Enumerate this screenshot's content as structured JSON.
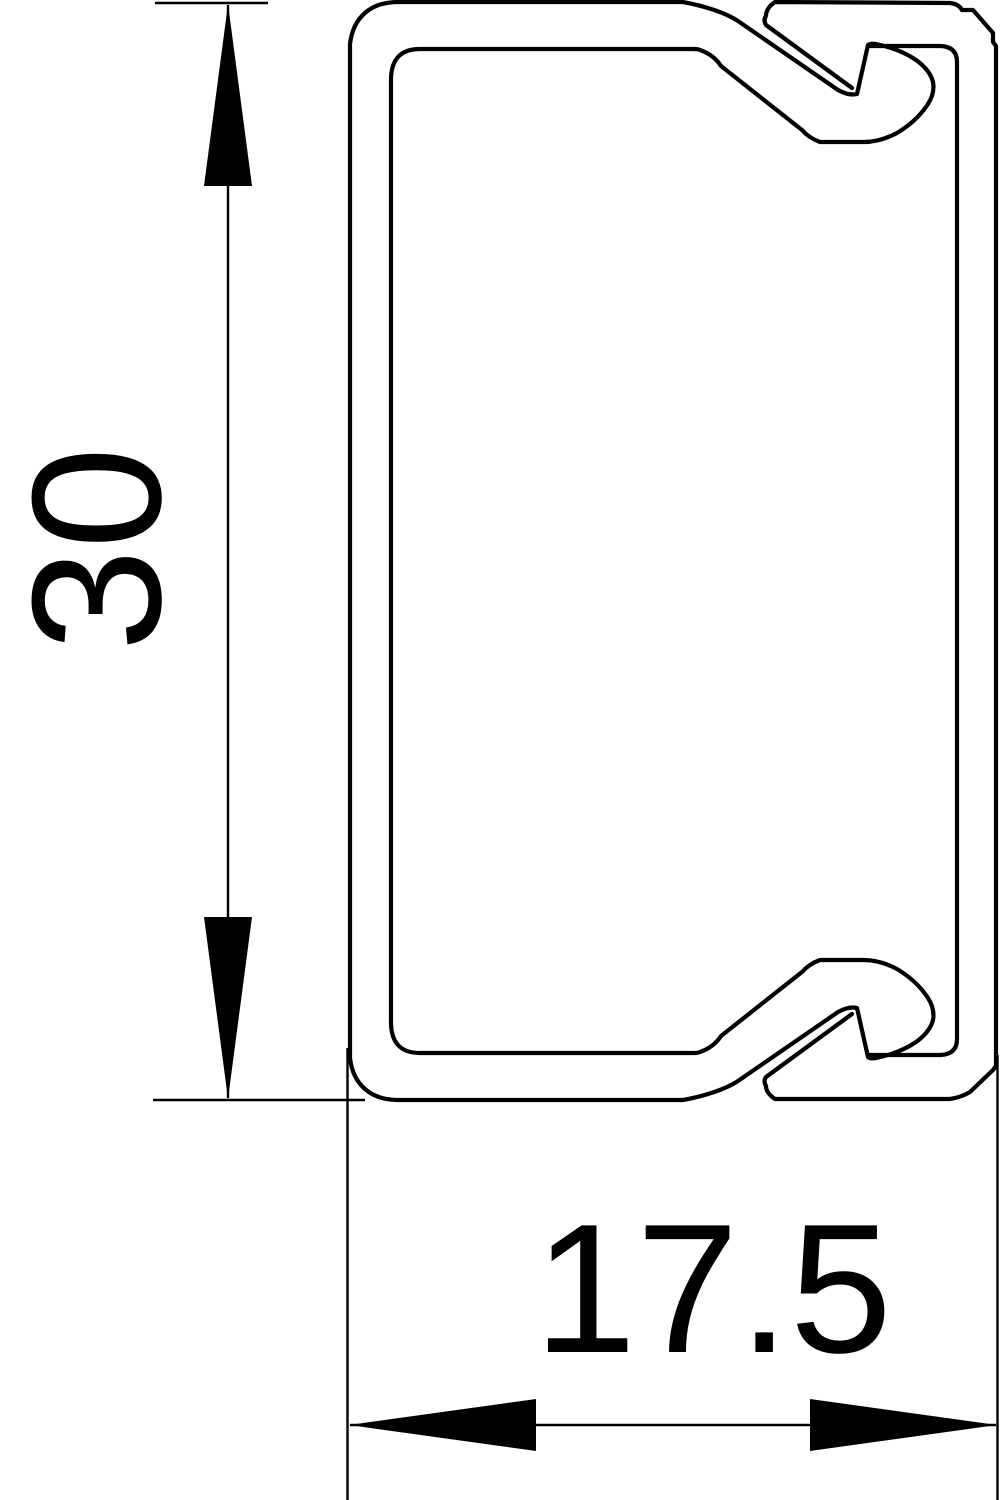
{
  "drawing": {
    "type": "technical-cross-section",
    "subject": "cable-trunking-profile-with-snap-on-cover",
    "background_color": "#ffffff",
    "line_color": "#000000",
    "dimensions": {
      "height": {
        "value": "30",
        "orientation": "vertical",
        "side": "left"
      },
      "width": {
        "value": "17.5",
        "orientation": "horizontal",
        "side": "bottom"
      }
    }
  }
}
